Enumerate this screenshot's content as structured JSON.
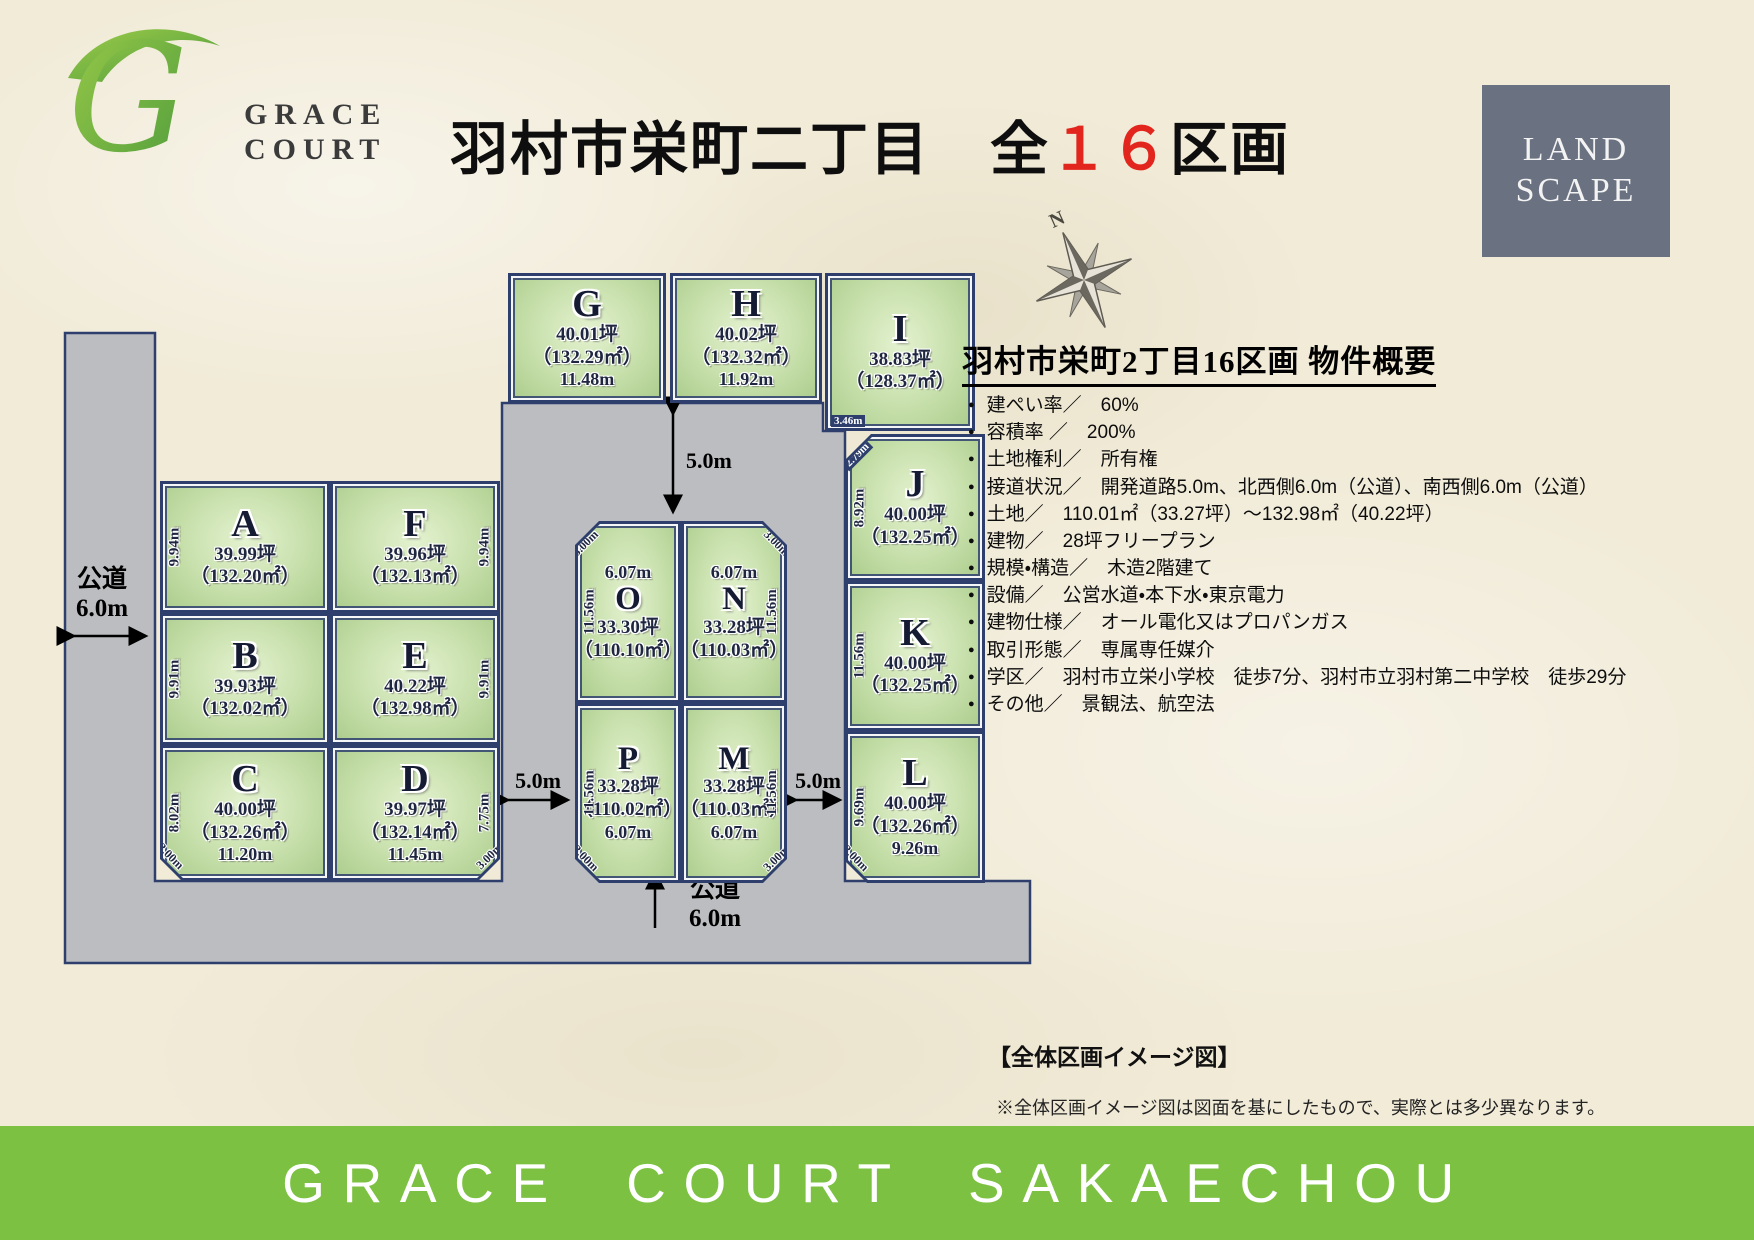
{
  "logo": {
    "monogram": "G",
    "name_line1": "GRACE",
    "name_line2": "COURT"
  },
  "header": {
    "title_pre": "羽村市栄町二丁目　全",
    "title_highlight": "１６",
    "title_post": "区画",
    "badge_line1": "LAND",
    "badge_line2": "SCAPE",
    "compass_label": "N"
  },
  "map": {
    "plots": [
      {
        "id": "G",
        "tsubo": "40.01坪",
        "sqm": "（132.29㎡）",
        "dim_bottom": "11.48m"
      },
      {
        "id": "H",
        "tsubo": "40.02坪",
        "sqm": "（132.32㎡）",
        "dim_bottom": "11.92m"
      },
      {
        "id": "I",
        "tsubo": "38.83坪",
        "sqm": "（128.37㎡）",
        "dim_corner": "3.46m"
      },
      {
        "id": "J",
        "tsubo": "40.00坪",
        "sqm": "（132.25㎡）",
        "dim_left": "8.92m",
        "dim_corner": "2.79m"
      },
      {
        "id": "K",
        "tsubo": "40.00坪",
        "sqm": "（132.25㎡）",
        "dim_left": "11.56m"
      },
      {
        "id": "L",
        "tsubo": "40.00坪",
        "sqm": "（132.26㎡）",
        "dim_left": "9.69m",
        "dim_bottom": "9.26m",
        "dim_corner": "3.00m"
      },
      {
        "id": "A",
        "tsubo": "39.99坪",
        "sqm": "（132.20㎡）",
        "dim_left": "9.94m"
      },
      {
        "id": "F",
        "tsubo": "39.96坪",
        "sqm": "（132.13㎡）",
        "dim_right": "9.94m"
      },
      {
        "id": "B",
        "tsubo": "39.93坪",
        "sqm": "（132.02㎡）",
        "dim_left": "9.91m"
      },
      {
        "id": "E",
        "tsubo": "40.22坪",
        "sqm": "（132.98㎡）",
        "dim_right": "9.91m"
      },
      {
        "id": "C",
        "tsubo": "40.00坪",
        "sqm": "（132.26㎡）",
        "dim_left": "8.02m",
        "dim_bottom": "11.20m",
        "dim_corner": "3.00m"
      },
      {
        "id": "D",
        "tsubo": "39.97坪",
        "sqm": "（132.14㎡）",
        "dim_right": "7.75m",
        "dim_bottom": "11.45m",
        "dim_corner": "3.00m"
      },
      {
        "id": "O",
        "tsubo": "33.30坪",
        "sqm": "（110.10㎡）",
        "dim_top": "6.07m",
        "dim_left": "11.56m",
        "dim_corner": "3.00m"
      },
      {
        "id": "N",
        "tsubo": "33.28坪",
        "sqm": "（110.03㎡）",
        "dim_top": "6.07m",
        "dim_right": "11.56m",
        "dim_corner": "3.00m"
      },
      {
        "id": "P",
        "tsubo": "33.28坪",
        "sqm": "（110.02㎡）",
        "dim_bottom": "6.07m",
        "dim_left": "11.56m",
        "dim_corner": "3.00m"
      },
      {
        "id": "M",
        "tsubo": "33.28坪",
        "sqm": "（110.03㎡）",
        "dim_bottom": "6.07m",
        "dim_right": "11.56m",
        "dim_corner": "3.00m"
      }
    ],
    "road_labels": {
      "left_name": "公道",
      "left_width": "6.0m",
      "top_gap": "5.0m",
      "center_gap": "5.0m",
      "right_gap": "5.0m",
      "bottom_name": "公道",
      "bottom_width": "6.0m"
    }
  },
  "overview": {
    "title": "羽村市栄町2丁目16区画 物件概要",
    "items": [
      "建ぺい率／　60%",
      "容積率 ／　200%",
      "土地権利／　所有権",
      "接道状況／　開発道路5.0m、北西側6.0m（公道）、南西側6.0m（公道）",
      "土地／　110.01㎡（33.27坪）～132.98㎡（40.22坪）",
      "建物／　28坪フリープラン",
      "規模・構造／　木造2階建て",
      "設備／　公営水道・本下水・東京電力",
      "建物仕様／　オール電化又はプロパンガス",
      "取引形態／　専属専任媒介",
      "学区／　羽村市立栄小学校　徒歩7分、羽村市立羽村第二中学校　徒歩29分",
      "その他／　景観法、航空法"
    ]
  },
  "caption": {
    "title": "【全体区画イメージ図】",
    "note": "※全体区画イメージ図は図面を基にしたもので、実際とは多少異なります。"
  },
  "footer": {
    "banner": "GRACE COURT SAKAECHOU"
  },
  "colors": {
    "accent_green": "#7cc142",
    "plot_green": "#c6dfaa",
    "road_gray": "#bcbdc1",
    "navy": "#2e3f6e",
    "badge_gray": "#6a7180",
    "highlight_red": "#e3261d"
  }
}
